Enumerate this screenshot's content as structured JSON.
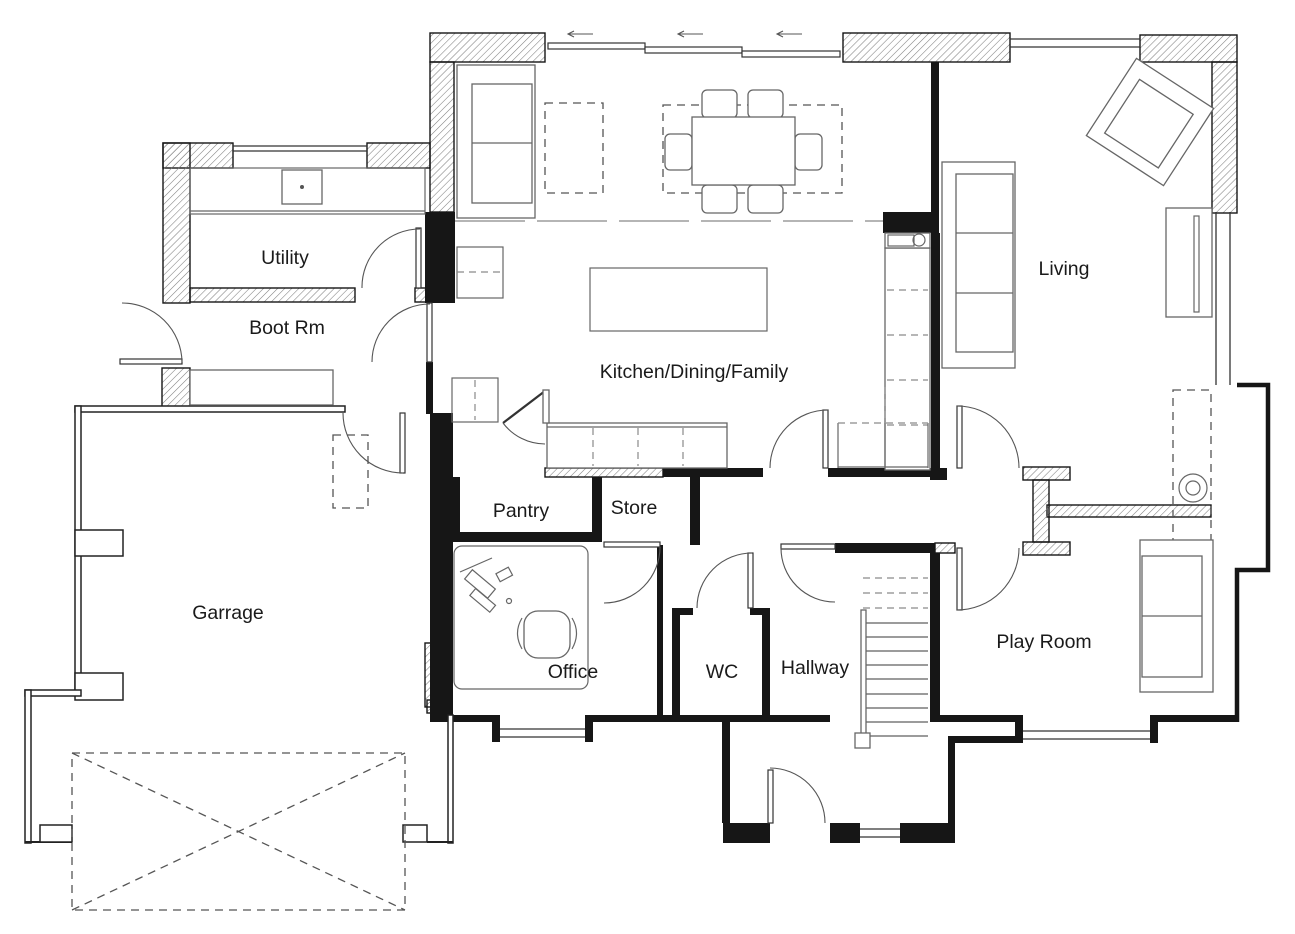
{
  "title": "Ground floor plan drawing",
  "colors": {
    "background": "#ffffff",
    "wall_solid": "#161616",
    "wall_hatch_lines": "#808080",
    "furniture_outline": "#666666",
    "dashed_outline": "#555555",
    "beam_line": "#b5b5b5",
    "label_text": "#1a1a1a"
  },
  "rooms": [
    {
      "id": "utility",
      "label": "Utility"
    },
    {
      "id": "boot-rm",
      "label": "Boot Rm"
    },
    {
      "id": "kitchen-dining-family",
      "label": "Kitchen/Dining/Family"
    },
    {
      "id": "living",
      "label": "Living"
    },
    {
      "id": "pantry",
      "label": "Pantry"
    },
    {
      "id": "store",
      "label": "Store"
    },
    {
      "id": "garage",
      "label": "Garrage"
    },
    {
      "id": "office",
      "label": "Office"
    },
    {
      "id": "wc",
      "label": "WC"
    },
    {
      "id": "hallway",
      "label": "Hallway"
    },
    {
      "id": "play-room",
      "label": "Play Room"
    }
  ],
  "plan_elements": {
    "furniture": [
      "kitchen-sofa",
      "rug",
      "dining-table",
      "dining-chairs",
      "kitchen-island",
      "kitchen-counter",
      "kitchen-tall-units",
      "utility-counter-with-sink",
      "boot-room-bench",
      "office-desk",
      "office-chair",
      "living-sofa",
      "living-armchair",
      "media-unit",
      "log-burner-stove",
      "play-room-sofa",
      "under-stair-cupboard"
    ],
    "features": [
      "stairs",
      "sliding-patio-doors",
      "windows",
      "door-swings",
      "garage-door-dashed-box",
      "chimney-breast-dashed",
      "ceiling-beam-line"
    ]
  }
}
